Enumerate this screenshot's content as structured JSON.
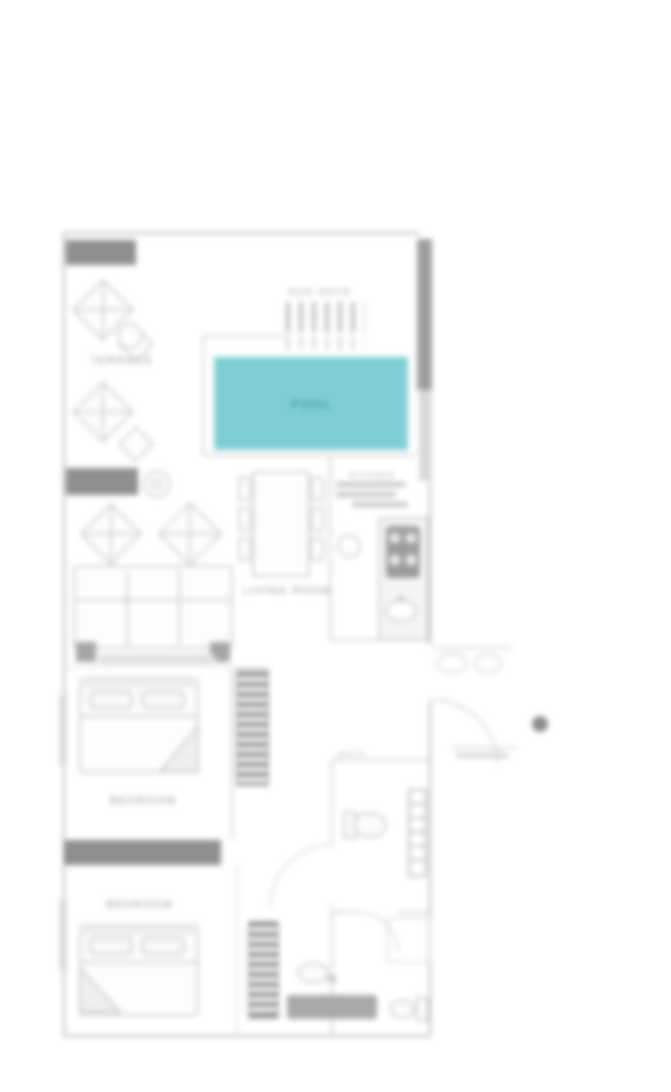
{
  "title": "Villa floor plan",
  "colors": {
    "pool_fill": "#7ecfd3",
    "pool_text": "#2e8f95",
    "wall_dark": "#8f8f8f",
    "wall_light": "#bdbdbd",
    "label_gray": "#9a9a9a"
  },
  "rooms": {
    "terrace": {
      "label": "TERRACE"
    },
    "sun_deck": {
      "label": "SUN DECK"
    },
    "pool": {
      "label": "POOL"
    },
    "living_room": {
      "label": "LIVING ROOM"
    },
    "kitchen": {
      "label": "KITCHEN"
    },
    "bedroom_1": {
      "label": "BEDROOM"
    },
    "bedroom_2": {
      "label": "BEDROOM"
    },
    "bathroom": {
      "label": "BATH"
    }
  }
}
